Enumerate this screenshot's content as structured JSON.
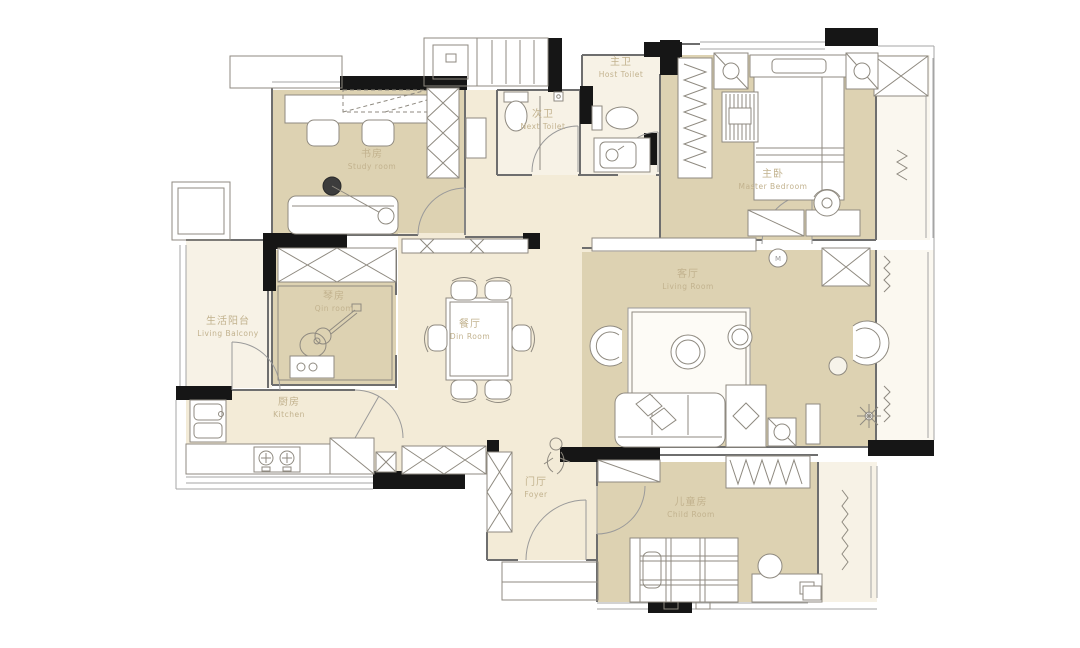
{
  "colors": {
    "floor_tan": "#ddd2b2",
    "floor_cream": "#f3ebd7",
    "floor_light": "#f7f2e6",
    "wall_black": "#161616",
    "line_gray": "#8a8a8a",
    "furniture_stroke": "#8f8a80",
    "label_color": "#c2b28e",
    "background": "#ffffff"
  },
  "rooms": [
    {
      "id": "study-room",
      "label_zh": "书房",
      "label_en": "Study room"
    },
    {
      "id": "next-toilet",
      "label_zh": "次卫",
      "label_en": "Next Toilet"
    },
    {
      "id": "host-toilet",
      "label_zh": "主卫",
      "label_en": "Host Toilet"
    },
    {
      "id": "master-bedroom",
      "label_zh": "主卧",
      "label_en": "Master Bedroom"
    },
    {
      "id": "living-balcony",
      "label_zh": "生活阳台",
      "label_en": "Living Balcony"
    },
    {
      "id": "qin-room",
      "label_zh": "琴房",
      "label_en": "Qin room"
    },
    {
      "id": "dining-room",
      "label_zh": "餐厅",
      "label_en": "Din Room"
    },
    {
      "id": "living-room",
      "label_zh": "客厅",
      "label_en": "Living Room"
    },
    {
      "id": "kitchen",
      "label_zh": "厨房",
      "label_en": "Kitchen"
    },
    {
      "id": "foyer",
      "label_zh": "门厅",
      "label_en": "Foyer"
    },
    {
      "id": "child-room",
      "label_zh": "儿童房",
      "label_en": "Child Room"
    }
  ],
  "fixtures": {
    "ac_fan_label": "M"
  }
}
